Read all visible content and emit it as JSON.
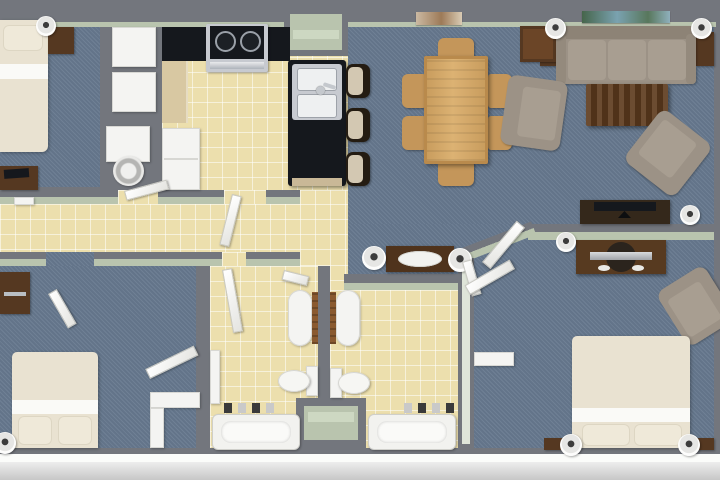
{
  "meta": {
    "type": "3d-floor-plan",
    "view": "top-down",
    "description": "Top-down 3D rendered floor plan of a multi-bedroom apartment with kitchen, dining area, living room, hallway, two bathrooms and three bedrooms"
  },
  "palette": {
    "wall_gray": "#73767d",
    "wall_face_green": "#b9c4ae",
    "carpet_blue": "#67798f",
    "tile_yellow": "#ecdfad",
    "counter_black": "#15181d",
    "wood_dark": "#553821",
    "wood_oak": "#c4965a",
    "upholstery_taupe": "#9c9286",
    "bedding_cream": "#e9e2d1",
    "fixture_white": "#f4f4f2",
    "stainless_steel": "#c7cad0",
    "exterior_white": "#fbfcfa",
    "ground_gray": "#d9d9d9"
  },
  "rooms": [
    {
      "id": "bedroom-1",
      "name": "Bedroom 1",
      "floor": "carpet",
      "furniture": [
        {
          "item": "bed",
          "count": 1
        },
        {
          "item": "nightstand",
          "count": 1
        },
        {
          "item": "table-lamp",
          "count": 1
        },
        {
          "item": "dresser-with-tv",
          "count": 1
        },
        {
          "item": "closet",
          "count": 2
        }
      ]
    },
    {
      "id": "laundry-closet",
      "name": "Laundry Closet",
      "floor": "none",
      "furniture": [
        {
          "item": "washer",
          "count": 1
        }
      ]
    },
    {
      "id": "kitchen",
      "name": "Kitchen",
      "floor": "tile",
      "furniture": [
        {
          "item": "range-stove",
          "count": 1
        },
        {
          "item": "black-counter",
          "count": 2
        },
        {
          "item": "wood-counter",
          "count": 1
        },
        {
          "item": "refrigerator",
          "count": 1
        },
        {
          "item": "island-with-sink",
          "count": 1
        },
        {
          "item": "bar-stool",
          "count": 3
        },
        {
          "item": "pantry",
          "count": 1
        }
      ]
    },
    {
      "id": "dining-area",
      "name": "Dining Area",
      "floor": "carpet",
      "furniture": [
        {
          "item": "dining-table",
          "count": 1
        },
        {
          "item": "dining-chair",
          "count": 6
        },
        {
          "item": "wall-art",
          "count": 1
        },
        {
          "item": "side-table",
          "count": 1
        }
      ]
    },
    {
      "id": "living-room",
      "name": "Living Room",
      "floor": "carpet",
      "furniture": [
        {
          "item": "sofa",
          "count": 1
        },
        {
          "item": "sofa-side-console",
          "count": 2
        },
        {
          "item": "coffee-table",
          "count": 1
        },
        {
          "item": "armchair",
          "count": 2
        },
        {
          "item": "tv-console-with-tv",
          "count": 1
        },
        {
          "item": "floor-lamp",
          "count": 3
        },
        {
          "item": "wall-art",
          "count": 1
        }
      ]
    },
    {
      "id": "hallway",
      "name": "Hallway",
      "floor": "tile",
      "furniture": [
        {
          "item": "console-table-with-bowl",
          "count": 1
        },
        {
          "item": "table-lamp",
          "count": 2
        },
        {
          "item": "wall-frame",
          "count": 1
        }
      ]
    },
    {
      "id": "bathroom-1",
      "name": "Bathroom 1",
      "floor": "tile",
      "furniture": [
        {
          "item": "vanity-sink",
          "count": 1
        },
        {
          "item": "toilet",
          "count": 1
        },
        {
          "item": "bathtub",
          "count": 1
        },
        {
          "item": "counter",
          "count": 1
        }
      ]
    },
    {
      "id": "bathroom-2",
      "name": "Bathroom 2",
      "floor": "tile",
      "furniture": [
        {
          "item": "vanity-sink",
          "count": 1
        },
        {
          "item": "toilet",
          "count": 1
        },
        {
          "item": "bathtub",
          "count": 1
        },
        {
          "item": "linen-closet",
          "count": 1
        }
      ]
    },
    {
      "id": "bedroom-2",
      "name": "Bedroom 2",
      "floor": "carpet",
      "furniture": [
        {
          "item": "bed",
          "count": 1
        },
        {
          "item": "dresser",
          "count": 1
        },
        {
          "item": "table-lamp",
          "count": 1
        },
        {
          "item": "closet",
          "count": 1
        }
      ]
    },
    {
      "id": "bedroom-3",
      "name": "Bedroom 3",
      "floor": "carpet",
      "furniture": [
        {
          "item": "bed",
          "count": 1
        },
        {
          "item": "nightstand",
          "count": 2
        },
        {
          "item": "table-lamp",
          "count": 4
        },
        {
          "item": "tv-console-with-tv",
          "count": 1
        },
        {
          "item": "armchair",
          "count": 1
        },
        {
          "item": "closet",
          "count": 1
        }
      ]
    }
  ],
  "doors": {
    "open_door_panels": 9
  }
}
